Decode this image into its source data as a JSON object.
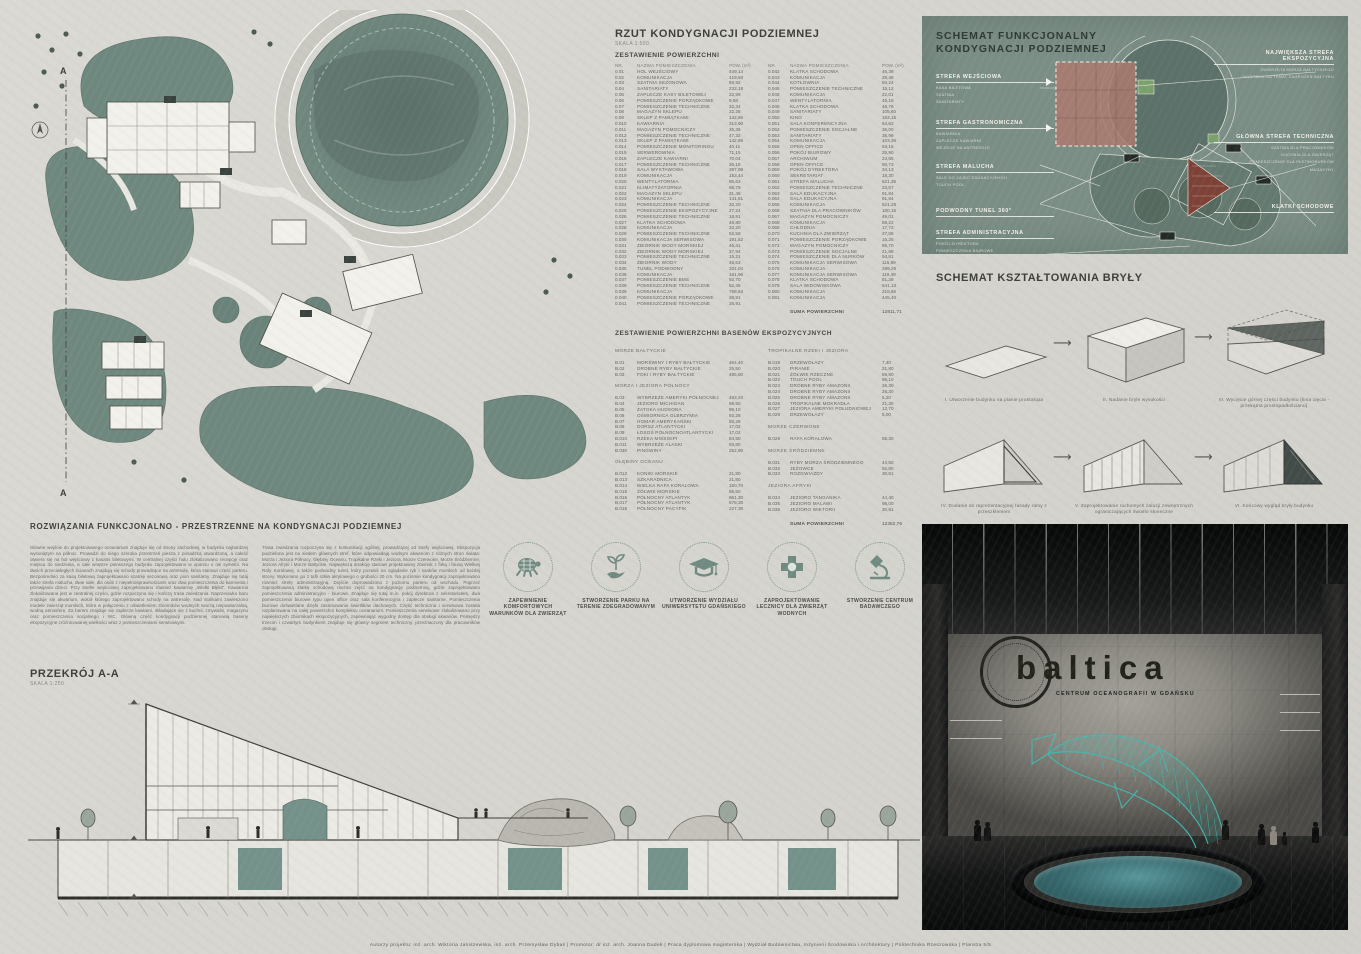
{
  "plan_section": {
    "title": "RZUT KONDYGNACJI PODZIEMNEJ",
    "scale": "SKALA 1:500",
    "cut_mark": "A"
  },
  "rooms_table": {
    "title": "ZESTAWIENIE POWIERZCHNI",
    "headers": {
      "nr": "NR.",
      "name": "NAZWA POMIESZCZENIA",
      "pow": "POW. (m²)"
    },
    "left": [
      [
        "0.01",
        "HOL WEJŚCIOWY",
        "449,14"
      ],
      [
        "0.02",
        "KOMUNIKACJA",
        "419,93"
      ],
      [
        "0.03",
        "SZATNIA SEZONOWA",
        "93,92"
      ],
      [
        "0.04",
        "SANITARIATY",
        "232,18"
      ],
      [
        "0.05",
        "ZAPLECZE KASY BILETOWEJ",
        "22,99"
      ],
      [
        "0.06",
        "POMIESZCZENIE PORZĄDKOWE",
        "9,58"
      ],
      [
        "0.07",
        "POMIESZCZENIE TECHNICZNE",
        "32,34"
      ],
      [
        "0.08",
        "MAGAZYN SKLEPU",
        "22,25"
      ],
      [
        "0.09",
        "SKLEP Z PAMIĄTKAMI",
        "142,86"
      ],
      [
        "0.010",
        "KAWIARNIA",
        "313,90"
      ],
      [
        "0.011",
        "MAGAZYN POMOCNICZY",
        "25,36"
      ],
      [
        "0.012",
        "POMIESZCZENIE TECHNICZNE",
        "47,32"
      ],
      [
        "0.013",
        "SKLEP Z PAMIĄTKAMI",
        "142,86"
      ],
      [
        "0.014",
        "POMIESZCZENIE MONITORINGU",
        "40,11"
      ],
      [
        "0.015",
        "SERWEROWNIA",
        "71,15"
      ],
      [
        "0.016",
        "ZAPLECZE KAWIARNI",
        "70,04"
      ],
      [
        "0.017",
        "POMIESZCZENIE TECHNICZNE",
        "36,18"
      ],
      [
        "0.018",
        "SALA WYSTAWOWA",
        "397,99"
      ],
      [
        "0.019",
        "KOMUNIKACJA",
        "153,44"
      ],
      [
        "0.020",
        "WENTYLATORNIA",
        "85,63"
      ],
      [
        "0.021",
        "KLIMATYZATORNIA",
        "86,79"
      ],
      [
        "0.022",
        "MAGAZYN SKLEPU",
        "31,48"
      ],
      [
        "0.023",
        "KOMUNIKACJA",
        "141,81"
      ],
      [
        "0.024",
        "POMIESZCZENIE TECHNICZNE",
        "32,20"
      ],
      [
        "0.025",
        "POMIESZCZENIE EKSPOZYCYJNE",
        "27,24"
      ],
      [
        "0.026",
        "POMIESZCZENIE TECHNICZNE",
        "18,91"
      ],
      [
        "0.027",
        "KLATKA SCHODOWA",
        "46,80"
      ],
      [
        "0.028",
        "KOMUNIKACJA",
        "33,20"
      ],
      [
        "0.029",
        "POMIESZCZENIE TECHNICZNE",
        "52,59"
      ],
      [
        "0.030",
        "KOMUNIKACJA SERWISOWA",
        "191,52"
      ],
      [
        "0.031",
        "ZBIORNIK WODY MORSKIEJ",
        "46,41"
      ],
      [
        "0.032",
        "ZBIORNIK WODY MORSKIEJ",
        "27,94"
      ],
      [
        "0.033",
        "POMIESZCZENIE TECHNICZNE",
        "15,21"
      ],
      [
        "0.034",
        "ZBIORNIK WODY",
        "46,53"
      ],
      [
        "0.035",
        "TUNEL PODWODNY",
        "331,04"
      ],
      [
        "0.036",
        "KOMUNIKACJA",
        "181,96"
      ],
      [
        "0.037",
        "POMIESZCZENIE BMS",
        "92,70"
      ],
      [
        "0.038",
        "POMIESZCZENIE TECHNICZNE",
        "52,45"
      ],
      [
        "0.039",
        "KOMUNIKACJA",
        "768,63"
      ],
      [
        "0.040",
        "POMIESZCZENIE PORZĄDKOWE",
        "28,91"
      ],
      [
        "0.041",
        "POMIESZCZENIE TECHNICZNE",
        "28,91"
      ]
    ],
    "right": [
      [
        "0.042",
        "KLATKA SCHODOWA",
        "46,38"
      ],
      [
        "0.043",
        "KOMUNIKACJA",
        "28,48"
      ],
      [
        "0.044",
        "KOTŁOWNIA",
        "60,24"
      ],
      [
        "0.045",
        "POMIESZCZENIE TECHNICZNE",
        "15,12"
      ],
      [
        "0.046",
        "KOMUNIKACJA",
        "22,01"
      ],
      [
        "0.047",
        "WENTYLATORNIA",
        "45,18"
      ],
      [
        "0.048",
        "KLATKA SCHODOWA",
        "48,76"
      ],
      [
        "0.049",
        "SANITARIATY",
        "105,60"
      ],
      [
        "0.050",
        "KINO",
        "193,15"
      ],
      [
        "0.051",
        "SALA KONFERENCYJNA",
        "64,62"
      ],
      [
        "0.052",
        "POMIESZCZENIE SOCJALNE",
        "36,00"
      ],
      [
        "0.053",
        "SANITARIATY",
        "35,99"
      ],
      [
        "0.054",
        "KOMUNIKACJA",
        "103,36"
      ],
      [
        "0.055",
        "OPEN OFFICE",
        "63,15"
      ],
      [
        "0.056",
        "POKÓJ BIUROWY",
        "25,90"
      ],
      [
        "0.057",
        "ARCHIWUM",
        "23,65"
      ],
      [
        "0.058",
        "OPEN OFFICE",
        "50,73"
      ],
      [
        "0.059",
        "POKÓJ DYREKTORA",
        "34,13"
      ],
      [
        "0.060",
        "SEKRETARIAT",
        "18,30"
      ],
      [
        "0.061",
        "STREFA MALUCHA",
        "621,35"
      ],
      [
        "0.062",
        "POMIESZCZENIE TECHNICZNE",
        "23,57"
      ],
      [
        "0.063",
        "SALA EDUKACYJNA",
        "91,84"
      ],
      [
        "0.064",
        "SALA EDUKACYJNA",
        "91,84"
      ],
      [
        "0.065",
        "KOMUNIKACJA",
        "521,29"
      ],
      [
        "0.066",
        "SZATNIA DLA PRACOWNIKÓW",
        "100,15"
      ],
      [
        "0.067",
        "MAGAZYN POMOCNICZY",
        "49,01"
      ],
      [
        "0.068",
        "KOMUNIKACJA",
        "58,22"
      ],
      [
        "0.069",
        "CHŁODNIA",
        "17,72"
      ],
      [
        "0.070",
        "KUCHNIA DLA ZWIERZĄT",
        "27,08"
      ],
      [
        "0.071",
        "POMIESZCZENIE PORZĄDKOWE",
        "16,26"
      ],
      [
        "0.072",
        "MAGAZYN POMOCNICZY",
        "65,70"
      ],
      [
        "0.073",
        "POMIESZCZENIE SOCJALNE",
        "21,88"
      ],
      [
        "0.074",
        "POMIESZCZENIE DLA NURKÓW",
        "54,81"
      ],
      [
        "0.075",
        "KOMUNIKACJA SERWISOWA",
        "115,69"
      ],
      [
        "0.076",
        "KOMUNIKACJA",
        "299,29"
      ],
      [
        "0.077",
        "KOMUNIKACJA SERWISOWA",
        "119,49"
      ],
      [
        "0.078",
        "KLATKA SCHODOWA",
        "81,28"
      ],
      [
        "0.079",
        "SALA WIDOWISKOWA",
        "641,13"
      ],
      [
        "0.080",
        "KOMUNIKACJA",
        "218,65"
      ],
      [
        "0.081",
        "KOMUNIKACJA",
        "445,40"
      ]
    ],
    "sum_label": "SUMA POWIERZCHNI",
    "sum_value": "12811,71"
  },
  "pools_table": {
    "title": "ZESTAWIENIE POWIERZCHNI BASENÓW EKSPOZYCYJNYCH",
    "left_groups": [
      {
        "heading": "MORZE BAŁTYCKIE",
        "rows": [
          [
            "B.01",
            "MORŚWINY I RYBY BAŁTYCKIE",
            "464,40"
          ],
          [
            "B.02",
            "DROBNE RYBY BAŁTYCKIE",
            "25,50"
          ],
          [
            "B.03",
            "FOKI I RYBY BAŁTYCKIE",
            "495,50"
          ]
        ]
      },
      {
        "heading": "MORZA I JEZIORA PÓŁNOCY",
        "rows": [
          [
            "B.03",
            "WYBRZEŻE AMERYKI PÓŁNOCNEJ",
            "483,20"
          ],
          [
            "B.04",
            "JEZIORO MICHIGAN",
            "69,50"
          ],
          [
            "B.05",
            "ZATOKA HUDSONA",
            "99,10"
          ],
          [
            "B.06",
            "OŚMIORNICA OLBRZYMIA",
            "93,28"
          ],
          [
            "B.07",
            "HOMAR AMERYKAŃSKI",
            "93,28"
          ],
          [
            "B.08",
            "DORSZ ATLANTYCKI",
            "17,02"
          ],
          [
            "B.09",
            "ŁOSOŚ PÓŁNOCNOATLANTYCKI",
            "17,02"
          ],
          [
            "B.010",
            "RZEKA MISSISIPI",
            "84,50"
          ],
          [
            "B.011",
            "WYBRZEŻE ALASKI",
            "93,80"
          ],
          [
            "B.030",
            "PINGWINY",
            "252,90"
          ]
        ]
      },
      {
        "heading": "GŁĘBINY OCEANU",
        "rows": [
          [
            "B.012",
            "KONIKI MORSKIE",
            "21,80"
          ],
          [
            "B.013",
            "SZKARADNICA",
            "21,80"
          ],
          [
            "B.014",
            "WIELKA RAFA KORALOWA",
            "150,70"
          ],
          [
            "B.015",
            "ŻÓŁWIE MORSKIE",
            "85,50"
          ],
          [
            "B.016",
            "PÓŁNOCNY ATLANTYK",
            "861,30"
          ],
          [
            "B.017",
            "PÓŁNOCNY ATLANTYK",
            "578,38"
          ],
          [
            "B.018",
            "PÓŁNOCNY PACYFIK",
            "227,30"
          ]
        ]
      }
    ],
    "right_groups": [
      {
        "heading": "TROPIKALNE RZEKI I JEZIORA",
        "rows": [
          [
            "B.019",
            "DRZEWOŁAZY",
            "7,40"
          ],
          [
            "B.020",
            "PIRANIE",
            "21,80"
          ],
          [
            "B.021",
            "ŻÓŁWIE RZECZNE",
            "59,80"
          ],
          [
            "B.022",
            "TOUCH POOL",
            "95,10"
          ],
          [
            "B.023",
            "DROBNE RYBY AMAZONII",
            "26,30"
          ],
          [
            "B.024",
            "DROBNE RYBY AMAZONII",
            "26,30"
          ],
          [
            "B.025",
            "DROBNE RYBY AMAZONII",
            "5,20"
          ],
          [
            "B.026",
            "TROPIKALNE MOKRADŁA",
            "21,30"
          ],
          [
            "B.027",
            "JEZIORA AMERYKI POŁUDNIOWEJ",
            "12,70"
          ],
          [
            "B.028",
            "DRZEWOŁAZY",
            "5,00"
          ]
        ]
      },
      {
        "heading": "MORZE CZERWONE",
        "rows": [
          [
            "B.029",
            "RAFA KORALOWA",
            "85,30"
          ]
        ]
      },
      {
        "heading": "MORZE ŚRÓDZIEMNE",
        "rows": [
          [
            "B.031",
            "RYBY MORZA ŚRÓDZIEMNEGO",
            "44,50"
          ],
          [
            "B.032",
            "JEŻOWCE",
            "92,80"
          ],
          [
            "B.033",
            "ROZGWIAZDY",
            "30,81"
          ]
        ]
      },
      {
        "heading": "JEZIORA AFRYKI",
        "rows": [
          [
            "B.034",
            "JEZIORO TANGANIKA",
            "44,40"
          ],
          [
            "B.035",
            "JEZIORO MALAWI",
            "95,00"
          ],
          [
            "B.036",
            "JEZIORO WIKTORII",
            "30,81"
          ]
        ]
      }
    ],
    "sum_label": "SUMA POWIERZCHNI",
    "sum_value": "12352,76"
  },
  "functional": {
    "title_line1": "SCHEMAT FUNKCJONALNY",
    "title_line2": "KONDYGNACJI PODZIEMNEJ",
    "left": [
      {
        "title": "STREFA WEJŚCIOWA",
        "subs": [
          "KASA BILETOWA",
          "SZATNIA",
          "SANITARIATY"
        ]
      },
      {
        "title": "STREFA GASTRONOMICZNA",
        "subs": [
          "KAWIARNIA",
          "ZAPLECZE KAWIARNI",
          "WEJŚCIE NA ANTRESOLĘ"
        ]
      },
      {
        "title": "STREFA MALUCHA",
        "subs": [
          "SALE DO ZAJĘĆ EDUKACYJNYCH",
          "TOUCH POOL"
        ]
      },
      {
        "title": "PODWODNY TUNEL 360°",
        "subs": []
      },
      {
        "title": "STREFA ADMINISTRACYJNA",
        "subs": [
          "POKÓJ DYREKTORA",
          "POMIESZCZENIA BIUROWE",
          "SALA KONFERENCYJNA"
        ]
      }
    ],
    "right": [
      {
        "title": "NAJWIĘKSZA STREFA EKSPOZYCYJNA",
        "subs": [
          "ZWIERZĘTA MORZA BAŁTYCKIEGO",
          "WYSTAWA NA TEMAT ZAGROŻEŃ BAŁTYKU"
        ]
      },
      {
        "title": "GŁÓWNA STREFA TECHNICZNA",
        "subs": [
          "SZATNIA DLA PRACOWNIKÓW",
          "KUCHNIA DLA ZWIERZĄT",
          "POMIESZCZENIE DLA PŁETWONURKÓW",
          "MAGAZYNY"
        ]
      },
      {
        "title": "KLATKI SCHODOWE",
        "subs": []
      }
    ]
  },
  "massing": {
    "title": "SCHEMAT KSZTAŁTOWANIA BRYŁY",
    "steps": [
      {
        "caption": "I. Utworzenie budynku na planie prostokąta"
      },
      {
        "caption": "II. Nadanie bryle wysokości"
      },
      {
        "caption": "III. Wycięcie górnej części budynku (linia cięcia - przekątna prostopadłościanu)"
      },
      {
        "caption": "IV. Dodanie do reprezentacyjnej fasady ramy z przeszkleniem"
      },
      {
        "caption": "V. Zaprojektowanie ruchomych żaluzji zewnętrznych ograniczających światło słoneczne"
      },
      {
        "caption": "VI. Końcowy wygląd bryły budynku"
      }
    ],
    "arrow": "⟶"
  },
  "solutions": {
    "title": "ROZWIĄZANIA FUNKCJONALNO - PRZESTRZENNE NA KONDYGNACJI PODZIEMNEJ",
    "col1": "Główne wejście do projektowanego oceanarium znajduje się od strony zachodniej, w budynku najbardziej wysuniętym na północ. Prowadzi do niego szeroka przestrzeń piesza z posadzką utwardzoną, a całość otwiera się na hol wejściowy z kasami biletowymi. W centralnej części holu zlokalizowano recepcję oraz miejsca do siedzenia, a całe wnętrze pierwszego budynku zaprojektowano w oparciu o osi symetrii. Na dwóch przeciwległych ścianach znajdują się schody prowadzące na antresolę, która stanowi część parteru. Bezpośrednio za kasą biletową zaprojektowano szatnię sezonową oraz pion sanitarny. Znajduje się tutaj także strefa malucha, dwie sale, dla osób z niepełnosprawnościami oraz dwa pomieszczenia do karmienia i przewijania dzieci. Przy strefie wejściowej zaprojektowano również kawiarnię „Wielki Błękit”. Kawiarnia zlokalizowana jest w centralnej części, gdzie rozpoczyna się i kończy trasa zwiedzania. Naprzeciwko baru znajduje się akwarium, wokół którego zaprojektowano schody na antresolę. Nad stolikami zawieszono modele zwierząt morskich, które w połączeniu z oświetleniem zbiorników wodnych tworzą niepowtarzalną, wodną atmosferę. Za barem znajduje się zaplecze kawiarni, składające się z kuchni, zmywalni, magazynu oraz pomieszczenia socjalnego i WC. Główną część kondygnacji podziemnej stanowią baseny ekspozycyjne zróżnicowanej wielkości wraz z pomieszczeniami serwisowymi.",
    "col2": "Trasa zwiedzania rozpoczyna się z komunikacji ogólnej, prowadzącej od strefy wejściowej. Ekspozycja podzielona jest na siedem głównych stref, które odpowiadają wodnym akwenom z różnych stron świata: Morza i Jeziora Północy, Głębiny Oceanu, Tropikalne Rzeki i Jeziora, Morze Czerwone, Morze Śródziemne, Jeziora Afryki i Morze Bałtyckie. Największą atrakcję stanowi projektowany zbiornik z foką i fauną Wielkiej Rafy Koralowej, a także podwodny tunel, który pozwoli na oglądanie ryb i ssaków morskich od każdej strony. Wykonano go z tafli szkła akrylowego o grubości 20 cm. Na poziomie kondygnacji zaprojektowano również strefę administracyjną. Dojście doprowadzono z poziomu parteru od wschodu. Poprzez zaprojektowaną klatkę schodową można zejść na kondygnację podziemną, gdzie zaprojektowano pomieszczenia administracyjno - biurowe. Znajduje się tutaj m.in. pokój dyrektora z sekretariatem, dwa pomieszczenia biurowe typu open office oraz sala konferencyjna i zaplecze sanitarne. Pomieszczenia biurowe doświetlane dzięki zastosowaniu świetlików dachowych. Część techniczna i serwisowa została rozplanowana na całej powierzchni kompleksu oceanarium. Pomieszczenia serwisowe zlokalizowano przy największych zbiornikach ekspozycyjnych, zapewniając wygodny dostęp dla obsługi akwariów. Pomiędzy trzecim i czwartym budynkiem znajduje się główny segment techniczny, przeznaczony dla pracowników obsługi."
  },
  "goals": [
    {
      "icon": "turtle-icon",
      "label": "ZAPEWNIENIE KOMFORTOWYCH WARUNKÓW DLA ZWIERZĄT"
    },
    {
      "icon": "sprout-hand-icon",
      "label": "STWORZENIE PARKU NA TERENIE ZDEGRADOWANYM"
    },
    {
      "icon": "graduation-cap-icon",
      "label": "UTWORZENIE WYDZIAŁU UNIWERSYTETU GDAŃSKIEGO"
    },
    {
      "icon": "medical-cross-icon",
      "label": "ZAPROJEKTOWANIE LECZNICY DLA ZWIERZĄT WODNYCH"
    },
    {
      "icon": "microscope-icon",
      "label": "STWORZENIE CENTRUM BADAWCZEGO"
    }
  ],
  "section_drawing": {
    "title": "PRZEKRÓJ A-A",
    "scale": "SKALA 1:250"
  },
  "render": {
    "logo": "baltica",
    "tagline": "CENTRUM OCEANOGRAFII W GDAŃSKU"
  },
  "footer": {
    "text": "Autorzy projektu: inż. arch. Wiktoria Janiszewska, inż. arch. Przemysław Dybaś      |      Promotor: dr inż. arch. Joanna Dudek      |      Praca dyplomowa magisterska      |      Wydział Budownictwa, Inżynierii Środowiska i Architektury      |      Politechnika Rzeszowska      |      Plansza 5/5"
  },
  "colors": {
    "board": "#d8d7d1",
    "pool": "#6f887f",
    "pool_dark": "#5d756d",
    "panel": "#7b8e86",
    "accent_red": "#7d4136",
    "accent_pink": "#ab786e",
    "accent_green": "#7aa06b",
    "dolphin": "#3fbcb2",
    "ink": "#3e3e39"
  }
}
